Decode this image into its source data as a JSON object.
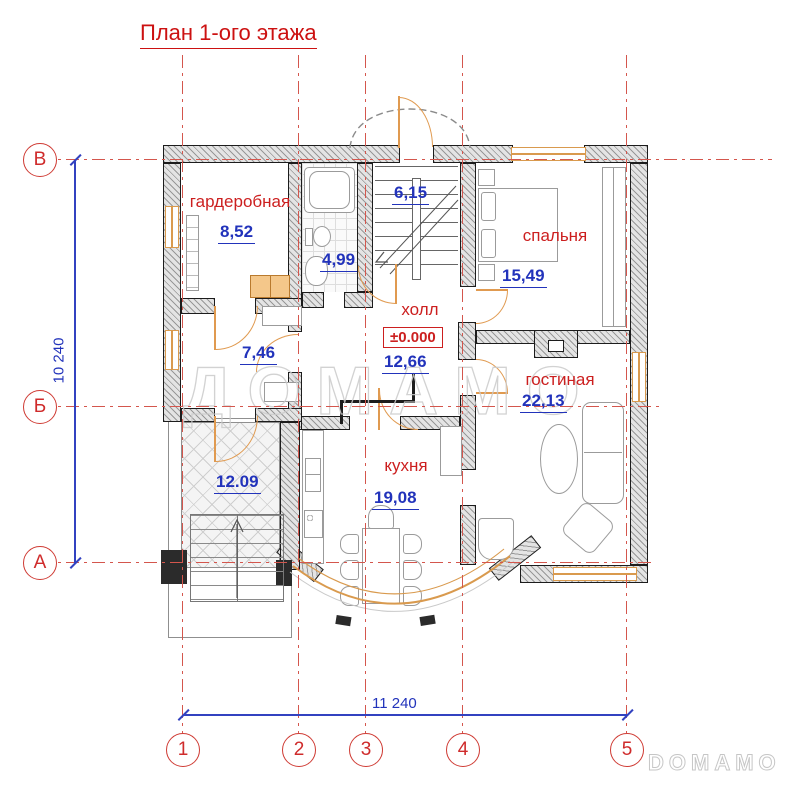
{
  "title": "План 1-ого этажа",
  "axes": {
    "rows": [
      "В",
      "Б",
      "А"
    ],
    "cols": [
      "1",
      "2",
      "3",
      "4",
      "5"
    ]
  },
  "dimensions": {
    "vertical": "10 240",
    "horizontal": "11 240"
  },
  "rooms": {
    "wardrobe": {
      "name": "гардеробная",
      "area": "8,52"
    },
    "bathroom": {
      "area": "4,99"
    },
    "stairs": {
      "area": "6,15"
    },
    "bedroom": {
      "name": "спальня",
      "area": "15,49"
    },
    "hall": {
      "name": "холл",
      "elevation": "±0.000",
      "area": "12,66"
    },
    "corridor": {
      "area": "7,46"
    },
    "living": {
      "name": "гостиная",
      "area": "22,13"
    },
    "kitchen": {
      "name": "кухня",
      "area": "19,08"
    },
    "terrace": {
      "area": "12.09"
    }
  },
  "watermarks": {
    "center": "ДОМАМО",
    "corner": "DOMAMO"
  },
  "colors": {
    "label_red": "#cc1f1f",
    "value_blue": "#2233bb",
    "axis_red": "#d4564d",
    "window_orange": "#d99a4e"
  }
}
